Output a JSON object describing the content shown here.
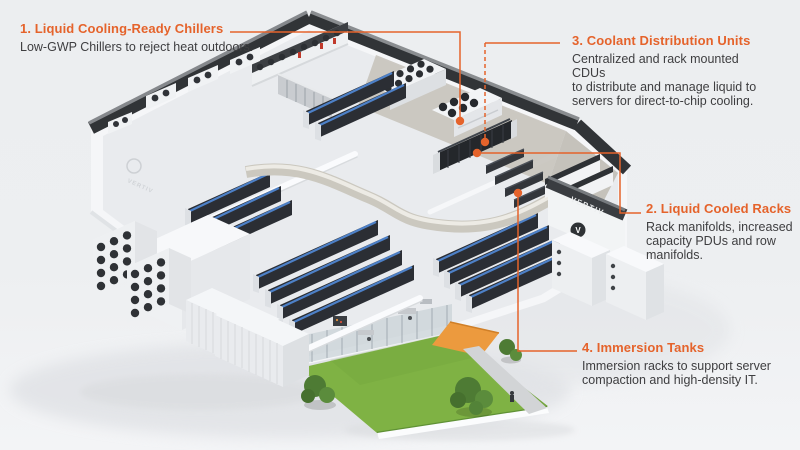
{
  "colors": {
    "accent": "#e5632b",
    "pipe_blue": "#4d80c7",
    "grass_green": "#7fb244",
    "roof_dark": "#313437"
  },
  "building": {
    "logo_text": "VERTIV"
  },
  "annotations": {
    "a1": {
      "title": "1.  Liquid Cooling-Ready Chillers",
      "desc": "Low-GWP Chillers to reject heat outdoors."
    },
    "a2": {
      "title": "2. Liquid Cooled Racks",
      "desc": "Rack manifolds, increased\ncapacity PDUs and row\nmanifolds."
    },
    "a3": {
      "title": "3. Coolant Distribution Units",
      "desc": "Centralized and rack mounted CDUs\nto distribute and manage liquid to\nservers for direct-to-chip cooling."
    },
    "a4": {
      "title": "4. Immersion Tanks",
      "desc": "Immersion racks to support server\ncompaction and high-density IT."
    }
  }
}
